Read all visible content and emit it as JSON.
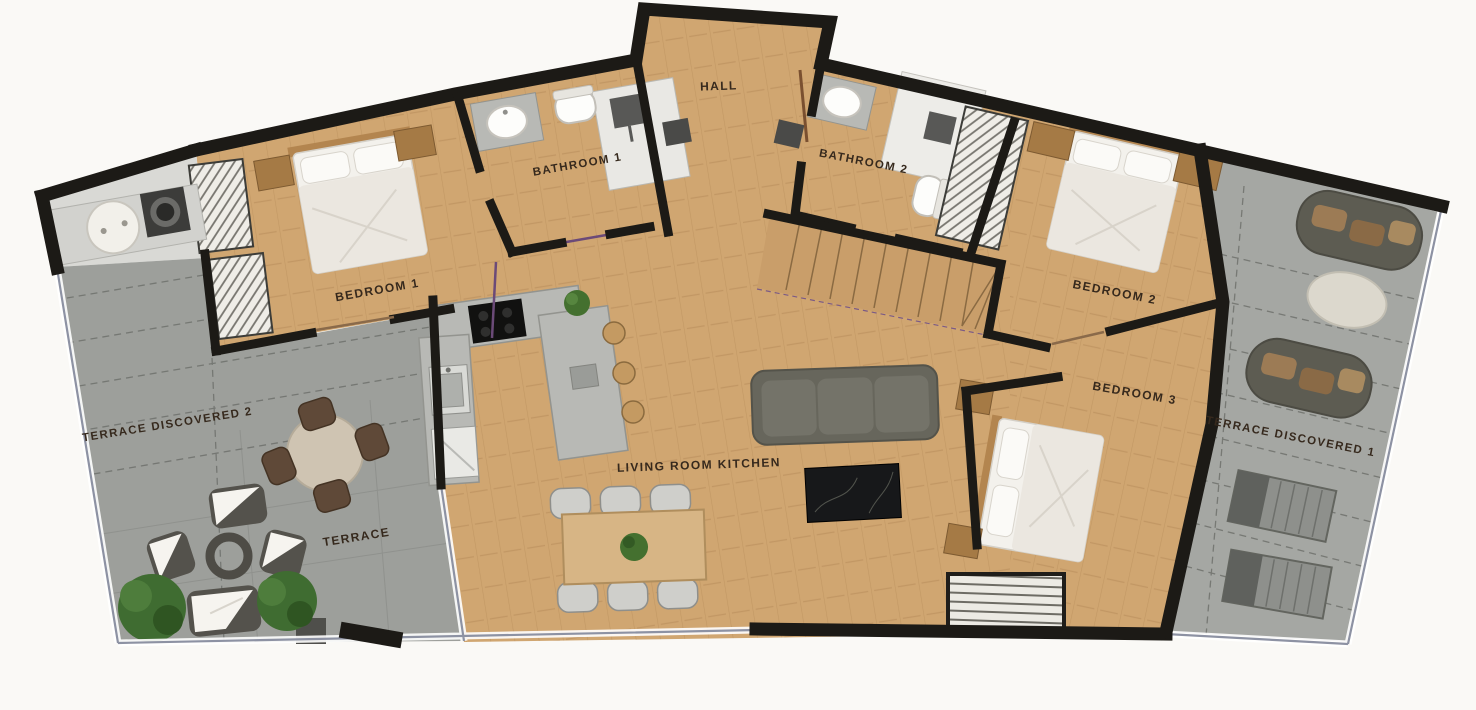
{
  "plan": {
    "type": "apartment-floor-plan",
    "rooms": {
      "hall": {
        "label": "HALL"
      },
      "bathroom_1": {
        "label": "BATHROOM 1"
      },
      "bathroom_2": {
        "label": "BATHROOM 2"
      },
      "bedroom_1": {
        "label": "BEDROOM 1"
      },
      "bedroom_2": {
        "label": "BEDROOM 2"
      },
      "bedroom_3": {
        "label": "BEDROOM 3"
      },
      "living_room_kitchen": {
        "label": "LIVING ROOM KITCHEN"
      },
      "terrace": {
        "label": "TERRACE"
      },
      "terrace_discovered_1": {
        "label": "TERRACE DISCOVERED 1"
      },
      "terrace_discovered_2": {
        "label": "TERRACE DISCOVERED 2"
      }
    },
    "colors": {
      "background": "#faf9f6",
      "wall": "#1c1a16",
      "wood_floor": "#d0a671",
      "terrace_floor": "#9d9f9b",
      "terrace_discovered_floor": "#a5a7a3",
      "utility_floor": "#d9d9d5",
      "label_text": "#36291d",
      "sofa": "#67665c",
      "bed_linen": "#f3f1ec",
      "wood_furniture": "#b3854f",
      "counter": "#b8b9b5",
      "plant": "#44702f",
      "marble_table": "#17181a",
      "glass_line": "#8d92a3"
    }
  }
}
